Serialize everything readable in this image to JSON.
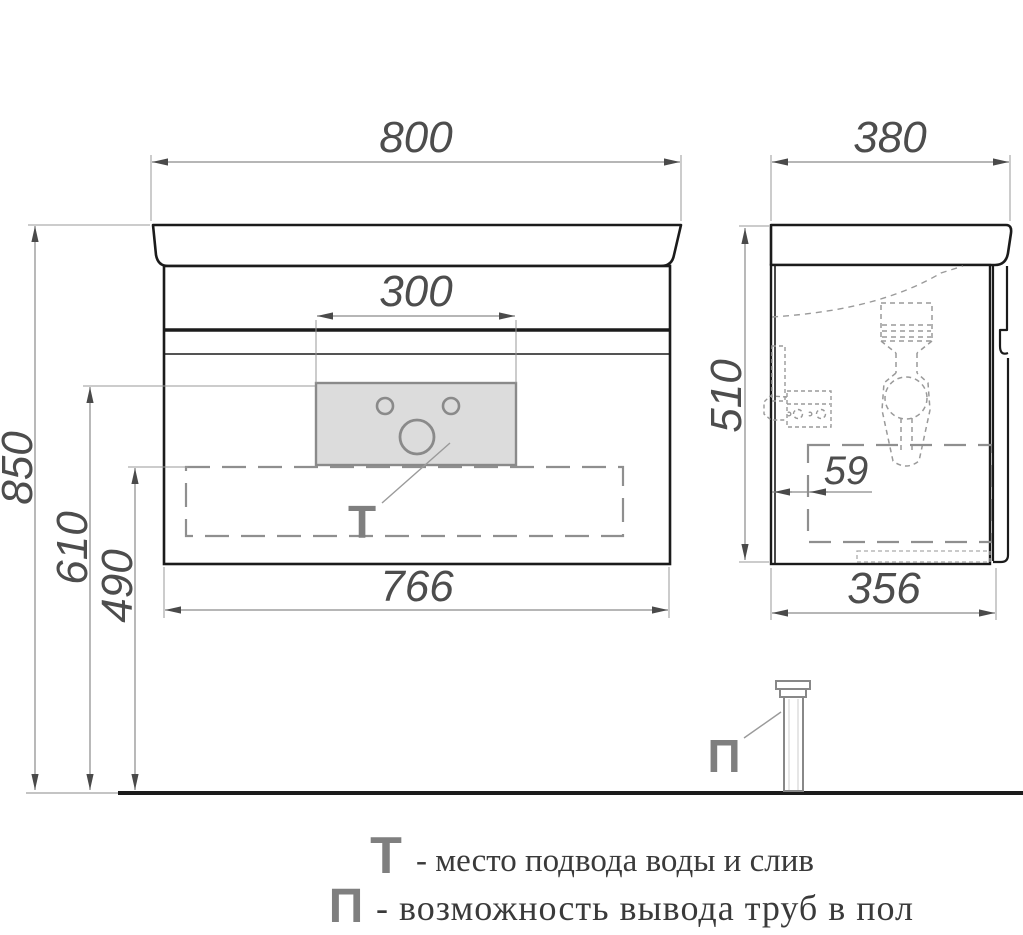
{
  "drawing_type": "bathroom vanity cabinet dimension drawing",
  "views": {
    "front": {
      "width_top": "800",
      "sink_cutout_width": "300",
      "width_bottom": "766",
      "height_total": "850",
      "height_to_panel": "610",
      "height_to_zone": "490",
      "marker": "Т"
    },
    "side": {
      "depth_top": "380",
      "height_body": "510",
      "wall_offset": "59",
      "depth_bottom": "356",
      "marker": "П"
    }
  },
  "legend": {
    "t_symbol": "Т",
    "t_text": "- место подвода воды и слив",
    "p_symbol": "П",
    "p_text": "- возможность вывода труб в пол"
  },
  "colors": {
    "object_line": "#1b1b1b",
    "dim_line": "#8a8a8a",
    "dim_text": "#4d4d4d",
    "arrow": "#4a4a4a",
    "marker_gray": "#7f7f7f",
    "panel_fill": "#dcdcdc",
    "dashed_detail": "#9a9a9a",
    "legend_text": "#3a3a3a"
  }
}
